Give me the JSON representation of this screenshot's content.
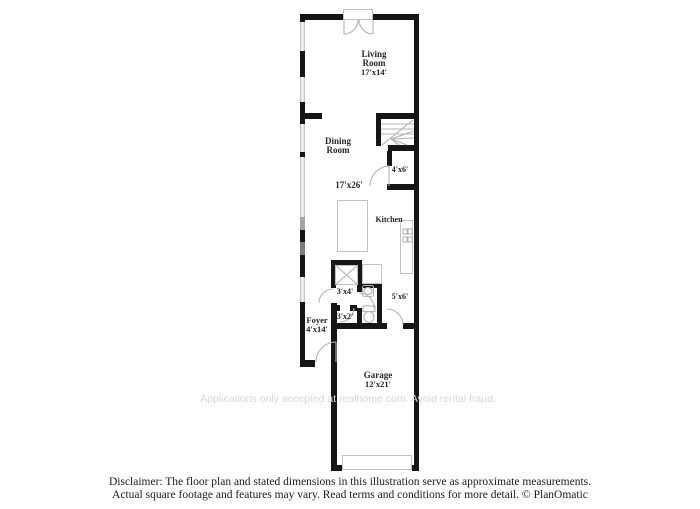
{
  "plan": {
    "rooms": {
      "living": {
        "name": "Living Room",
        "dims": "17'x14'"
      },
      "dining": {
        "name": "Dining Room",
        "dims": "17'x26'"
      },
      "kitchen": {
        "name": "Kitchen"
      },
      "closet_4x6": {
        "dims": "4'x6'"
      },
      "closet_3x4": {
        "dims": "3'x4'"
      },
      "hall_3x2": {
        "dims": "3'x2'"
      },
      "bath_5x6": {
        "dims": "5'x6'"
      },
      "foyer": {
        "name": "Foyer",
        "dims": "4'x14'"
      },
      "garage": {
        "name": "Garage",
        "dims": "12'x21'"
      }
    },
    "watermark": "Applications only accepted at realhome.com. Avoid rental fraud.",
    "colors": {
      "wall": "#161616",
      "window": "#c6c6c6",
      "fixture_outline": "#c2c2c2",
      "label_text": "#262626",
      "watermark_text": "#d7d7d7"
    }
  },
  "footer": {
    "disclaimer_line1": "Disclaimer: The floor plan and stated dimensions in this illustration serve as approximate measurements.",
    "disclaimer_line2": "Actual square footage and features may vary. Read terms and conditions for more detail. © PlanOmatic"
  }
}
